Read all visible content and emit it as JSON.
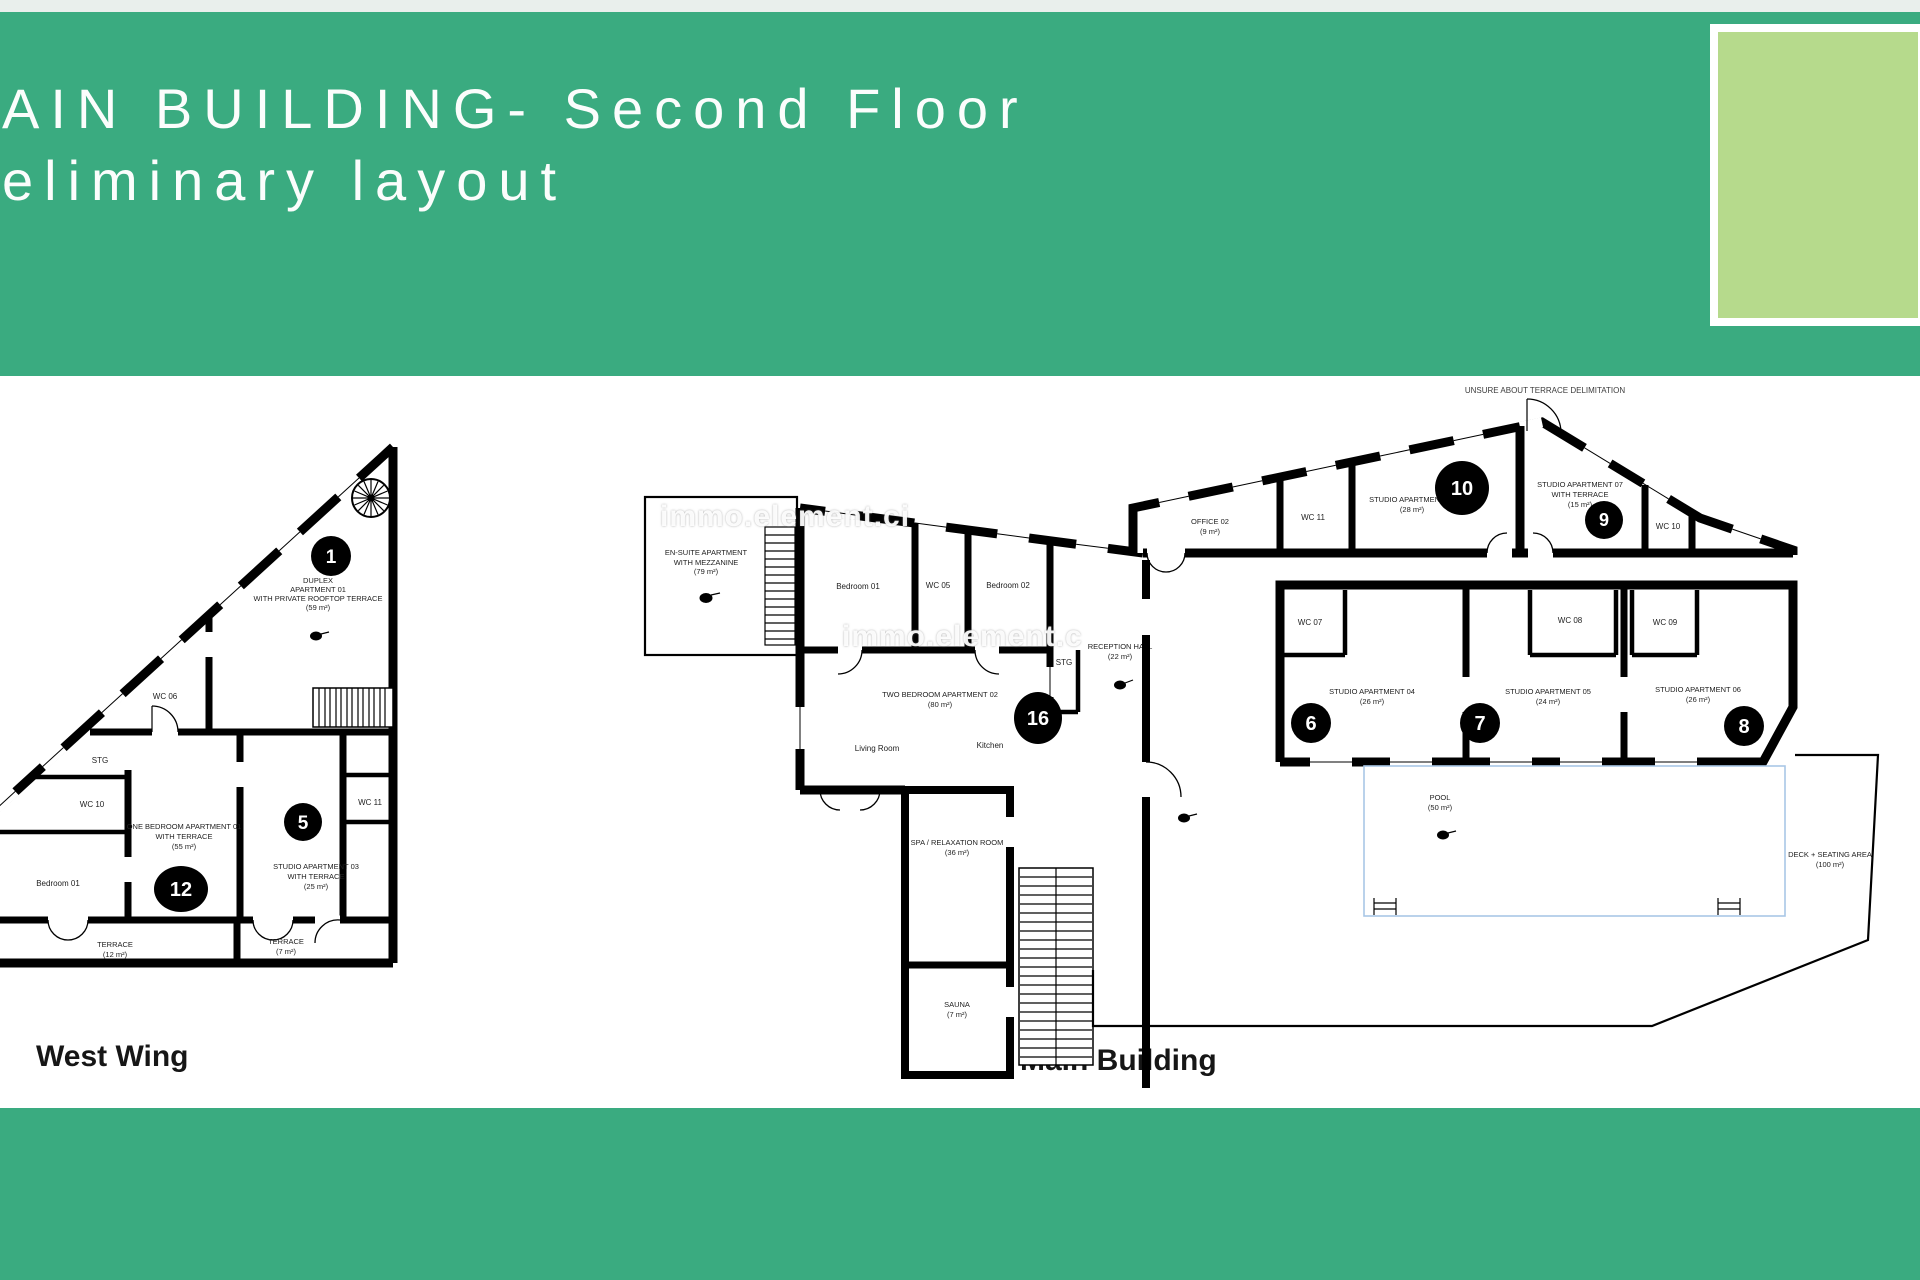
{
  "slide": {
    "title_line1": "AIN BUILDING- Second Floor",
    "title_line2": "eliminary layout",
    "captions": {
      "west_wing": "West Wing",
      "main_building": "Main Building"
    },
    "watermark": {
      "text1": "immo.element.ci",
      "text2": "immo.element.c"
    },
    "colors": {
      "band_green": "#3aab80",
      "accent_light_green": "#b6da8c",
      "top_strip": "#e9efec",
      "paper": "#ffffff",
      "wall_black": "#000000",
      "pool_blue": "#a9c7e6"
    }
  },
  "west_wing": {
    "keys": {
      "k1": "1",
      "k5": "5",
      "k12": "12"
    },
    "rooms": {
      "unit1": [
        "DUPLEX",
        "APARTMENT 01",
        "WITH PRIVATE ROOFTOP TERRACE",
        "(59 m²)"
      ],
      "wc06": "WC 06",
      "stg": "STG",
      "wc10": "WC 10",
      "bedroom01": "Bedroom 01",
      "apt01": [
        "ONE BEDROOM APARTMENT 01",
        "WITH TERRACE",
        "(55 m²)"
      ],
      "studio03": [
        "STUDIO APARTMENT 03",
        "WITH TERRACE",
        "(25 m²)"
      ],
      "wc11": "WC 11",
      "terrace_left": [
        "TERRACE",
        "(12 m²)"
      ],
      "terrace_right": [
        "TERRACE",
        "(7 m²)"
      ]
    }
  },
  "main_building": {
    "keys": {
      "k6": "6",
      "k7": "7",
      "k8": "8",
      "k9": "9",
      "k10": "10",
      "k16": "16"
    },
    "note": "UNSURE ABOUT TERRACE DELIMITATION",
    "rooms": {
      "suite": [
        "EN-SUITE APARTMENT",
        "WITH MEZZANINE",
        "(79 m²)"
      ],
      "bedroom01": "Bedroom 01",
      "wc05": "WC 05",
      "bedroom02": "Bedroom 02",
      "apt02": [
        "TWO BEDROOM APARTMENT 02",
        "(80 m²)"
      ],
      "living_room": "Living Room",
      "kitchen": "Kitchen",
      "stg": "STG",
      "reception": [
        "RECEPTION HALL",
        "(22 m²)"
      ],
      "office02": [
        "OFFICE 02",
        "(9 m²)"
      ],
      "wc11": "WC 11",
      "studio08": [
        "STUDIO APARTMENT 08",
        "(28 m²)"
      ],
      "studio07": [
        "STUDIO APARTMENT 07",
        "WITH TERRACE",
        "(15 m²)"
      ],
      "wc10": "WC 10",
      "wc07": "WC 07",
      "wc08": "WC 08",
      "wc09": "WC 09",
      "studio04": [
        "STUDIO APARTMENT 04",
        "(26 m²)"
      ],
      "studio05": [
        "STUDIO APARTMENT 05",
        "(24 m²)"
      ],
      "studio06": [
        "STUDIO APARTMENT 06",
        "(26 m²)"
      ],
      "spa": [
        "SPA / RELAXATION ROOM",
        "(36 m²)"
      ],
      "sauna": [
        "SAUNA",
        "(7 m²)"
      ],
      "pool": [
        "POOL",
        "(50 m²)"
      ],
      "deck": [
        "DECK + SEATING AREA",
        "(100 m²)"
      ]
    }
  }
}
